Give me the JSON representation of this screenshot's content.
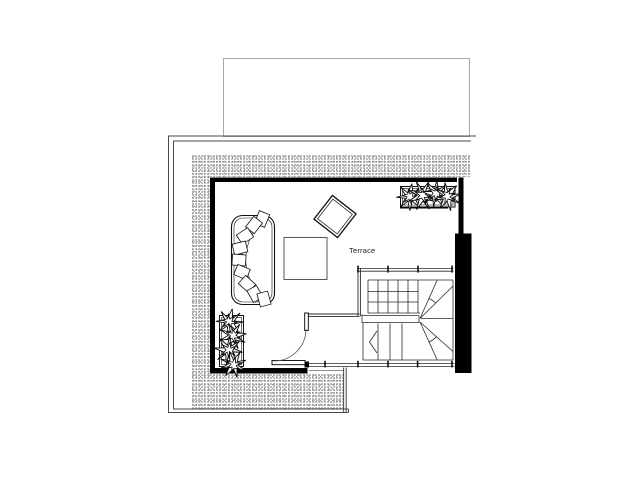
{
  "room": {
    "label": "Terrace"
  },
  "colors": {
    "background": "#ffffff",
    "wall": "#000000",
    "line": "#222222",
    "boundary": "#4a4a4a",
    "stipple_dark": "#8a8a8a",
    "stipple_light": "#b5b5b5",
    "light_outline": "#a8a8a8"
  },
  "symbols": {
    "sofa": "curved-sectional-sofa",
    "coffee_table": "square-coffee-table",
    "side_table": "rotated-square-side-table",
    "planter_top_right": "planter-box-with-plants",
    "planter_bottom_left": "planter-box-with-plants",
    "stairs": "u-shaped-stair-with-winders",
    "door": "door-with-swing-arc",
    "railing": "railing-with-post-ticks"
  }
}
